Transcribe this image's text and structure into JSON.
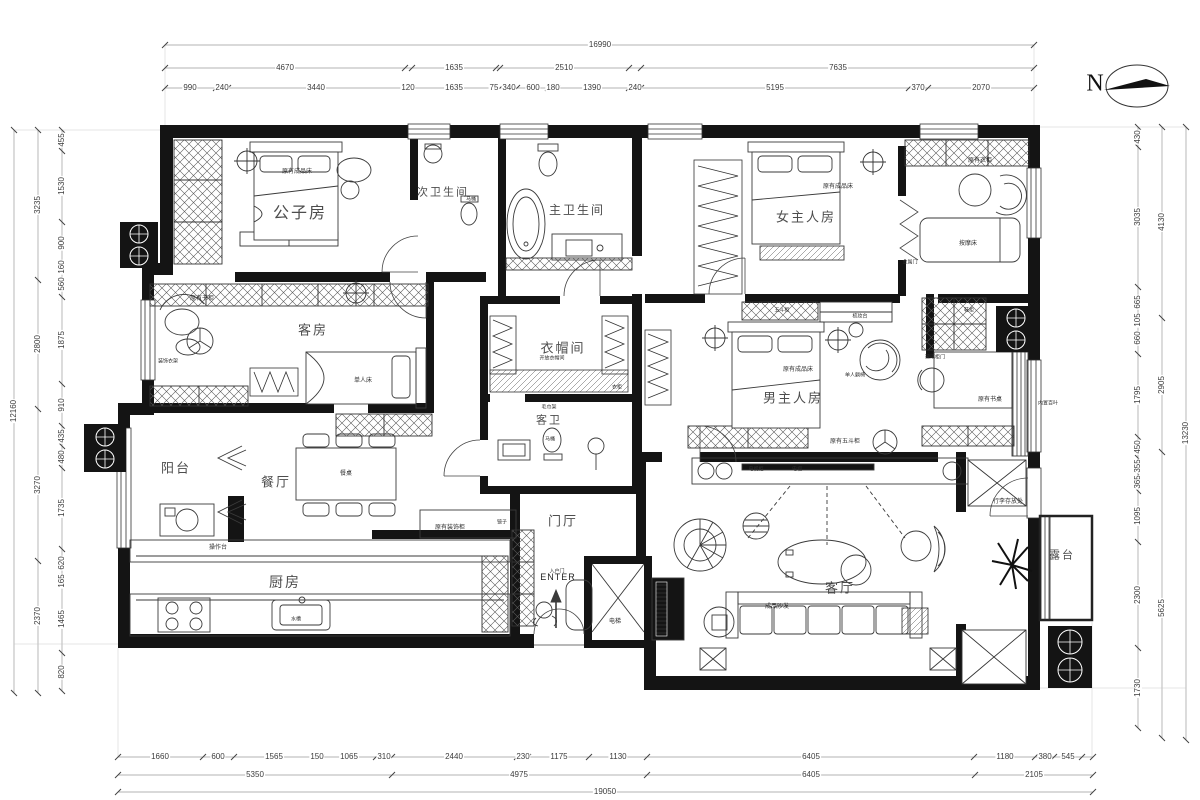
{
  "north": {
    "label": "N"
  },
  "entry": {
    "label": "ENTER"
  },
  "rooms": [
    {
      "t": "公子房",
      "x": 300,
      "y": 214,
      "fs": 16
    },
    {
      "t": "次卫生间",
      "x": 443,
      "y": 193,
      "fs": 11
    },
    {
      "t": "主卫生间",
      "x": 577,
      "y": 210,
      "fs": 12
    },
    {
      "t": "女主人房",
      "x": 806,
      "y": 217,
      "fs": 13
    },
    {
      "t": "客房",
      "x": 313,
      "y": 330,
      "fs": 13
    },
    {
      "t": "衣帽间",
      "x": 563,
      "y": 348,
      "fs": 13
    },
    {
      "t": "客卫",
      "x": 549,
      "y": 421,
      "fs": 11
    },
    {
      "t": "男主人房",
      "x": 793,
      "y": 398,
      "fs": 13
    },
    {
      "t": "阳台",
      "x": 176,
      "y": 468,
      "fs": 13
    },
    {
      "t": "餐厅",
      "x": 276,
      "y": 482,
      "fs": 13
    },
    {
      "t": "厨房",
      "x": 285,
      "y": 582,
      "fs": 14
    },
    {
      "t": "门厅",
      "x": 563,
      "y": 521,
      "fs": 13
    },
    {
      "t": "客厅",
      "x": 840,
      "y": 588,
      "fs": 13
    },
    {
      "t": "露台",
      "x": 1062,
      "y": 556,
      "fs": 11
    }
  ],
  "annotations": [
    {
      "t": "原有成品床",
      "x": 297,
      "y": 172
    },
    {
      "t": "马桶",
      "x": 471,
      "y": 200,
      "fs": 5
    },
    {
      "t": "原有成品床",
      "x": 838,
      "y": 187
    },
    {
      "t": "原有衣柜",
      "x": 980,
      "y": 161
    },
    {
      "t": "按摩床",
      "x": 968,
      "y": 244
    },
    {
      "t": "金属门",
      "x": 910,
      "y": 263,
      "fs": 5
    },
    {
      "t": "原有书柜",
      "x": 202,
      "y": 299
    },
    {
      "t": "装饰衣架",
      "x": 168,
      "y": 362,
      "fs": 5
    },
    {
      "t": "单人床",
      "x": 363,
      "y": 381
    },
    {
      "t": "衣柜",
      "x": 617,
      "y": 388,
      "fs": 5
    },
    {
      "t": "开放衣帽间",
      "x": 552,
      "y": 359,
      "fs": 5
    },
    {
      "t": "毛巾架",
      "x": 549,
      "y": 408,
      "fs": 5
    },
    {
      "t": "马桶",
      "x": 550,
      "y": 440,
      "fs": 5
    },
    {
      "t": "五斗柜",
      "x": 782,
      "y": 311,
      "fs": 5
    },
    {
      "t": "梳妆台",
      "x": 860,
      "y": 317,
      "fs": 5
    },
    {
      "t": "原有成品床",
      "x": 798,
      "y": 370
    },
    {
      "t": "原有五斗柜",
      "x": 845,
      "y": 442
    },
    {
      "t": "单人躺椅",
      "x": 855,
      "y": 376,
      "fs": 5
    },
    {
      "t": "鞋柜",
      "x": 969,
      "y": 311,
      "fs": 5
    },
    {
      "t": "玻璃柜门",
      "x": 935,
      "y": 358,
      "fs": 5
    },
    {
      "t": "原有书桌",
      "x": 990,
      "y": 400
    },
    {
      "t": "内置百叶",
      "x": 1048,
      "y": 404,
      "fs": 5
    },
    {
      "t": "餐桌",
      "x": 346,
      "y": 474
    },
    {
      "t": "操作台",
      "x": 218,
      "y": 548
    },
    {
      "t": "水槽",
      "x": 296,
      "y": 620,
      "fs": 5
    },
    {
      "t": "原有装饰柜",
      "x": 450,
      "y": 528
    },
    {
      "t": "镜子",
      "x": 502,
      "y": 523,
      "fs": 5
    },
    {
      "t": "入户门",
      "x": 557,
      "y": 572,
      "fs": 5
    },
    {
      "t": "电梯",
      "x": 615,
      "y": 622
    },
    {
      "t": "电视柜",
      "x": 756,
      "y": 470,
      "fs": 5
    },
    {
      "t": "电视",
      "x": 797,
      "y": 470,
      "fs": 5
    },
    {
      "t": "成品沙发",
      "x": 777,
      "y": 607
    },
    {
      "t": "行李存放处",
      "x": 1008,
      "y": 502
    }
  ],
  "dimensions": {
    "top_row1": [
      {
        "t": "16990",
        "x": 600,
        "y": 45
      }
    ],
    "top_row2": [
      {
        "t": "4670",
        "x": 285,
        "y": 68
      },
      {
        "t": "1635",
        "x": 454,
        "y": 68
      },
      {
        "t": "2510",
        "x": 564,
        "y": 68
      },
      {
        "t": "7635",
        "x": 838,
        "y": 68
      }
    ],
    "top_row3": [
      {
        "t": "990",
        "x": 190,
        "y": 88
      },
      {
        "t": "240",
        "x": 222,
        "y": 88
      },
      {
        "t": "3440",
        "x": 316,
        "y": 88
      },
      {
        "t": "120",
        "x": 408,
        "y": 88
      },
      {
        "t": "1635",
        "x": 454,
        "y": 88
      },
      {
        "t": "75",
        "x": 494,
        "y": 88
      },
      {
        "t": "340",
        "x": 509,
        "y": 88
      },
      {
        "t": "600",
        "x": 533,
        "y": 88
      },
      {
        "t": "180",
        "x": 553,
        "y": 88
      },
      {
        "t": "1390",
        "x": 592,
        "y": 88
      },
      {
        "t": "240",
        "x": 635,
        "y": 88
      },
      {
        "t": "5195",
        "x": 775,
        "y": 88
      },
      {
        "t": "370",
        "x": 918,
        "y": 88
      },
      {
        "t": "2070",
        "x": 981,
        "y": 88
      }
    ],
    "bottom_row1": [
      {
        "t": "1660",
        "x": 160,
        "y": 757
      },
      {
        "t": "600",
        "x": 218,
        "y": 757
      },
      {
        "t": "1565",
        "x": 274,
        "y": 757
      },
      {
        "t": "150",
        "x": 317,
        "y": 757
      },
      {
        "t": "1065",
        "x": 349,
        "y": 757
      },
      {
        "t": "310",
        "x": 384,
        "y": 757
      },
      {
        "t": "2440",
        "x": 454,
        "y": 757
      },
      {
        "t": "230",
        "x": 523,
        "y": 757
      },
      {
        "t": "1175",
        "x": 559,
        "y": 757
      },
      {
        "t": "1130",
        "x": 618,
        "y": 757
      },
      {
        "t": "6405",
        "x": 811,
        "y": 757
      },
      {
        "t": "1180",
        "x": 1005,
        "y": 757
      },
      {
        "t": "380",
        "x": 1045,
        "y": 757
      },
      {
        "t": "545",
        "x": 1068,
        "y": 757
      }
    ],
    "bottom_row2": [
      {
        "t": "5350",
        "x": 255,
        "y": 775
      },
      {
        "t": "4975",
        "x": 519,
        "y": 775
      },
      {
        "t": "6405",
        "x": 811,
        "y": 775
      },
      {
        "t": "2105",
        "x": 1034,
        "y": 775
      }
    ],
    "bottom_row3": [
      {
        "t": "19050",
        "x": 605,
        "y": 792
      }
    ],
    "left_col1": [
      {
        "t": "455",
        "x": 62,
        "y": 140
      },
      {
        "t": "1530",
        "x": 62,
        "y": 186
      },
      {
        "t": "900",
        "x": 62,
        "y": 243
      },
      {
        "t": "160",
        "x": 62,
        "y": 267
      },
      {
        "t": "560",
        "x": 62,
        "y": 284
      },
      {
        "t": "1875",
        "x": 62,
        "y": 340
      },
      {
        "t": "910",
        "x": 62,
        "y": 405
      },
      {
        "t": "435",
        "x": 62,
        "y": 436
      },
      {
        "t": "480",
        "x": 62,
        "y": 457
      },
      {
        "t": "1735",
        "x": 62,
        "y": 508
      },
      {
        "t": "620",
        "x": 62,
        "y": 563
      },
      {
        "t": "165",
        "x": 62,
        "y": 581
      },
      {
        "t": "1465",
        "x": 62,
        "y": 619
      },
      {
        "t": "820",
        "x": 62,
        "y": 672
      }
    ],
    "left_col2": [
      {
        "t": "3235",
        "x": 38,
        "y": 205
      },
      {
        "t": "2800",
        "x": 38,
        "y": 344
      },
      {
        "t": "3270",
        "x": 38,
        "y": 485
      },
      {
        "t": "2370",
        "x": 38,
        "y": 616
      }
    ],
    "left_col3": [
      {
        "t": "12160",
        "x": 14,
        "y": 411
      }
    ],
    "right_col1": [
      {
        "t": "430",
        "x": 1138,
        "y": 137
      },
      {
        "t": "3035",
        "x": 1138,
        "y": 217
      },
      {
        "t": "665",
        "x": 1138,
        "y": 302
      },
      {
        "t": "105",
        "x": 1138,
        "y": 320
      },
      {
        "t": "660",
        "x": 1138,
        "y": 338
      },
      {
        "t": "1795",
        "x": 1138,
        "y": 395
      },
      {
        "t": "450",
        "x": 1138,
        "y": 447
      },
      {
        "t": "355",
        "x": 1138,
        "y": 466
      },
      {
        "t": "365",
        "x": 1138,
        "y": 482
      },
      {
        "t": "1095",
        "x": 1138,
        "y": 516
      },
      {
        "t": "2300",
        "x": 1138,
        "y": 595
      },
      {
        "t": "1730",
        "x": 1138,
        "y": 688
      }
    ],
    "right_col2": [
      {
        "t": "4130",
        "x": 1162,
        "y": 222
      },
      {
        "t": "2905",
        "x": 1162,
        "y": 385
      },
      {
        "t": "5625",
        "x": 1162,
        "y": 608
      }
    ],
    "right_col3": [
      {
        "t": "13230",
        "x": 1186,
        "y": 433
      }
    ]
  }
}
